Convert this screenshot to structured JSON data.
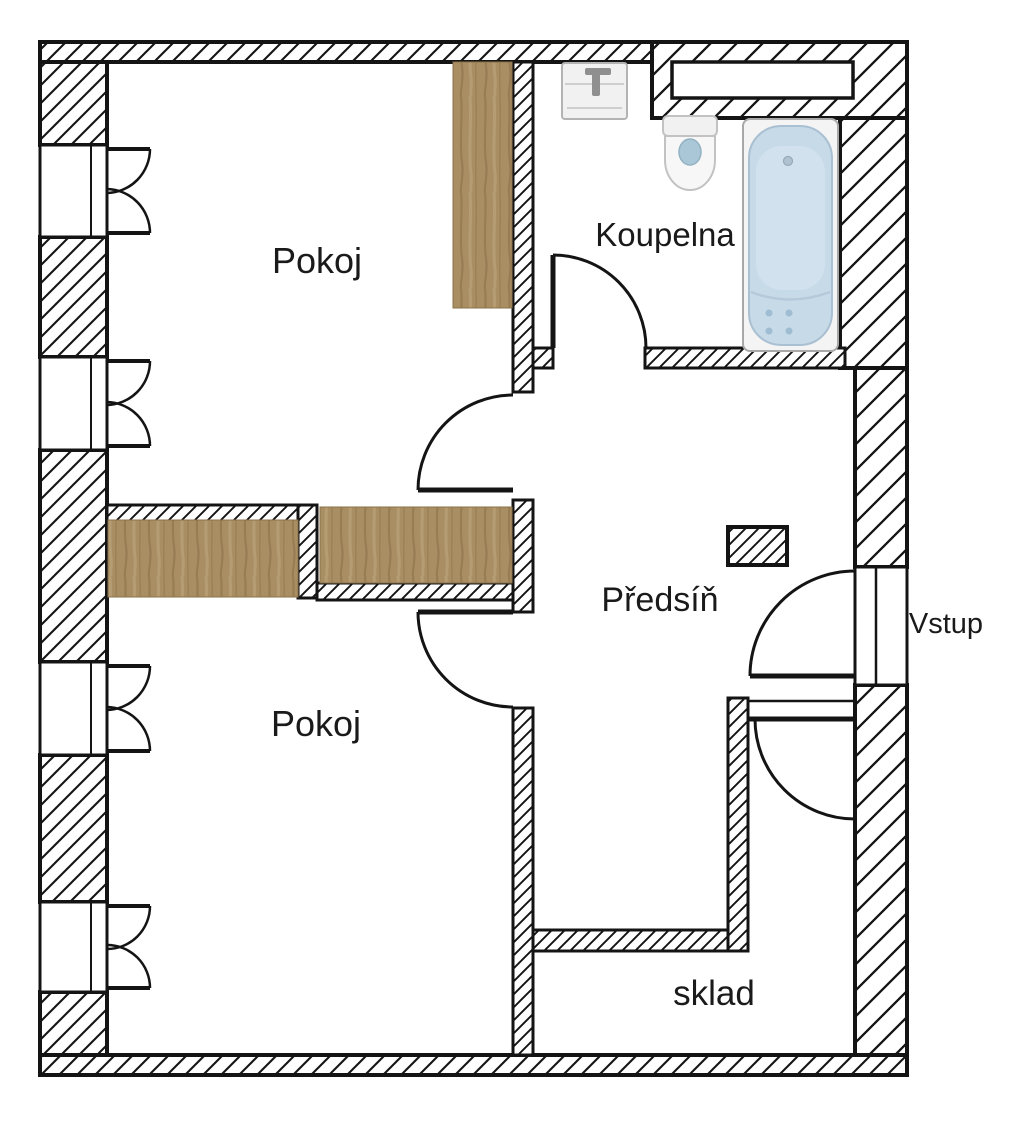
{
  "floorplan": {
    "rooms": [
      {
        "id": "pokoj-top",
        "label": "Pokoj"
      },
      {
        "id": "koupelna",
        "label": "Koupelna"
      },
      {
        "id": "predsin",
        "label": "Předsíň"
      },
      {
        "id": "pokoj-bottom",
        "label": "Pokoj"
      },
      {
        "id": "sklad",
        "label": "sklad"
      }
    ],
    "entrance": {
      "label": "Vstup"
    },
    "fixtures": [
      {
        "icon": "sink-icon"
      },
      {
        "icon": "toilet-icon"
      },
      {
        "icon": "bathtub-icon"
      }
    ],
    "furniture": [
      {
        "id": "wardrobe-top-room"
      },
      {
        "id": "wardrobe-middle-left"
      },
      {
        "id": "wardrobe-middle-right"
      }
    ],
    "colors": {
      "wall_line": "#141414",
      "background": "#ffffff",
      "wood": "#a98e63",
      "tub_fill": "#c7dae8",
      "fixture_gray": "#f1f1f1",
      "water_blue": "#a9c7d6"
    }
  }
}
